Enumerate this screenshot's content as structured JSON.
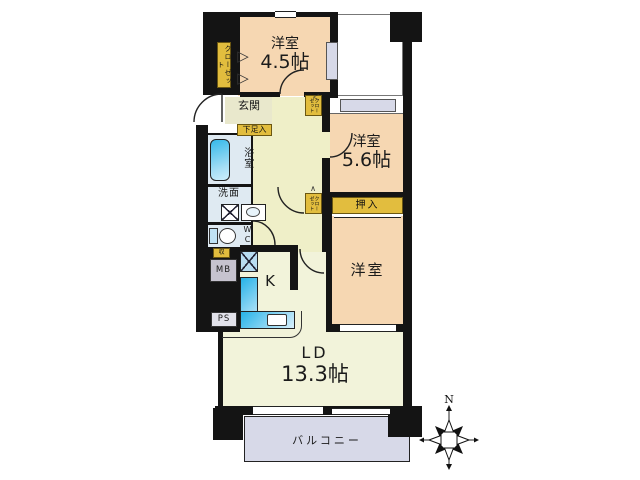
{
  "plan": {
    "rooms": {
      "bedroom1": {
        "name": "洋室",
        "size": "4.5帖"
      },
      "bedroom2": {
        "name": "洋室",
        "size": "5.6帖"
      },
      "bedroom3": {
        "name": "洋室"
      },
      "living_dining": {
        "name": "LD",
        "size": "13.3帖"
      },
      "kitchen": {
        "name": "K"
      },
      "entrance": {
        "name": "玄関"
      },
      "bathroom": {
        "name": "浴室"
      },
      "washroom": {
        "name": "洗面"
      },
      "toilet": {
        "name": "WC"
      },
      "balcony": {
        "name": "バルコニー"
      }
    },
    "storage": {
      "closet_main": "クローゼット",
      "closet_upper": "クローゼット",
      "closet_lower": "クローゼット",
      "shoe_cabinet": "下足入",
      "oshiire": "押入",
      "small_storage": "収"
    },
    "utilities": {
      "meter_box": "MB",
      "pipe_shaft": "PS"
    },
    "compass": {
      "label": "N"
    },
    "marks": {
      "chevron_right": "▷",
      "chevron_left": "＜",
      "caret": "∧"
    },
    "colors": {
      "wall": "#141414",
      "bedroom": "#f6d7b2",
      "living": "#f2f3da",
      "hall": "#efefc8",
      "entrance": "#e9e8cc",
      "wet_area": "#dfeaf2",
      "label_yellow": "#e2bd3e",
      "balcony": "#d7d9e8",
      "counter_blue": "#2ab5e8",
      "meter_box": "#c6c3cf"
    }
  }
}
